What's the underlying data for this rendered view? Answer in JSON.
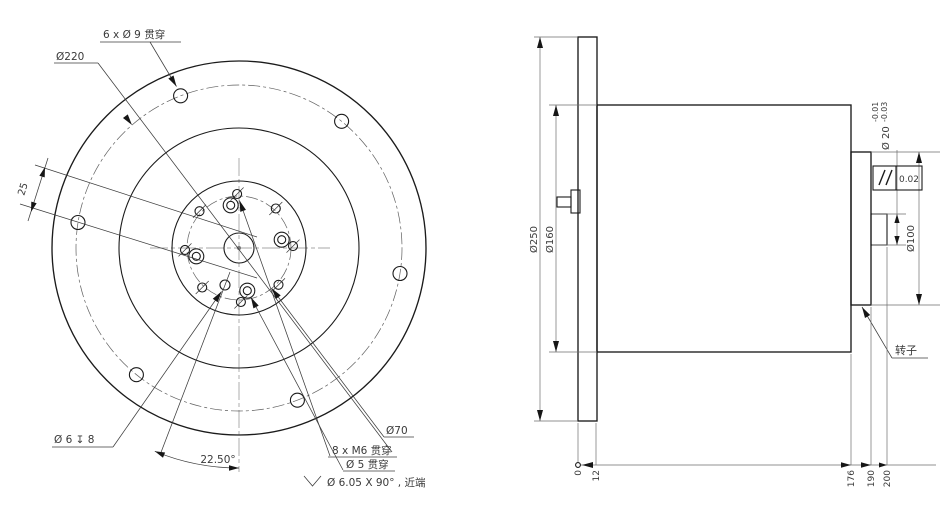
{
  "drawing": {
    "type": "mechanical engineering drawing, flange-mounted rotary component (front view and side view)",
    "front_view": {
      "labels": {
        "holes9": "6 x Ø 9 贯穿",
        "d220": "Ø220",
        "offset25": "25",
        "d6_depth": "Ø 6 ↧ 8",
        "angle": "22.50°",
        "d70": "Ø70",
        "m6": "8 x M6 贯穿",
        "d5": "Ø 5 贯穿",
        "csk": "Ø 6.05 X 90° , 近端"
      },
      "features": {
        "outer_bolt_holes": {
          "count": 6,
          "diameter": 9,
          "bolt_circle": 220,
          "through": true
        },
        "tapped_holes": {
          "count": 8,
          "thread": "M6",
          "bolt_circle": 70,
          "through": true
        },
        "csk_hole": {
          "diameter": 5,
          "countersink": "Ø6.05 X 90° near side",
          "through": true
        },
        "blind_hole": {
          "diameter": 6,
          "depth": 8
        },
        "angle_between_axes_deg": 22.5,
        "offset_mm": 25
      }
    },
    "side_view": {
      "labels": {
        "d250": "Ø250",
        "d160": "Ø160",
        "d100": "Ø100",
        "d20": "Ø 20",
        "d20_tol_upper": "-0.01",
        "d20_tol_lower": "-0.03",
        "parallelism_value": "0.02",
        "rotor": "转子",
        "ordinates": [
          "0",
          "12",
          "176",
          "190",
          "200"
        ]
      },
      "features": {
        "flange_diameter": 250,
        "flange_thickness": 12,
        "body_diameter": 160,
        "body_end": 176,
        "rotor_diameter": 100,
        "rotor_end": 190,
        "shaft_diameter": "20 -0.01/-0.03",
        "shaft_end": 200,
        "geometric_tolerance": {
          "symbol": "parallelism",
          "value": 0.02
        }
      }
    }
  }
}
